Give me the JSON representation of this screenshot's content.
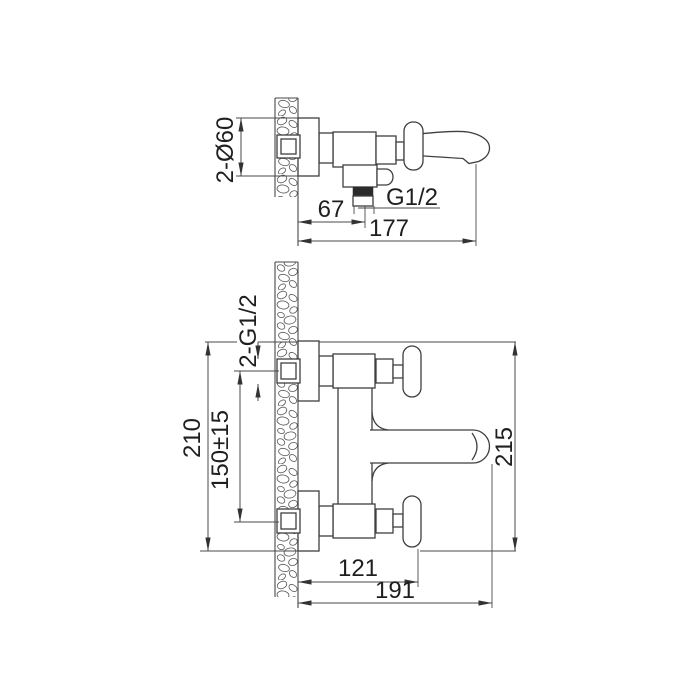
{
  "drawing": {
    "subject": "wall-mounted bath mixer tap installation dimensions",
    "side_view": {
      "escutcheon_diameter": "2-Ø60",
      "wall_to_outlet": "67",
      "wall_to_spout_outlet": "177",
      "outlet_thread": "G1/2"
    },
    "plan_view": {
      "inlet_threads": "2-G1/2",
      "overall_height": "210",
      "inlet_spacing": "150±15",
      "overall_projection": "215",
      "wall_to_handle_edge": "121",
      "wall_to_spout_tip": "191"
    },
    "colors": {
      "background": "#ffffff",
      "line": "#3f3f3f",
      "dimension": "#4a4a4a",
      "text": "#1f1f1f",
      "thread_fill": "#2b2b2b"
    }
  }
}
